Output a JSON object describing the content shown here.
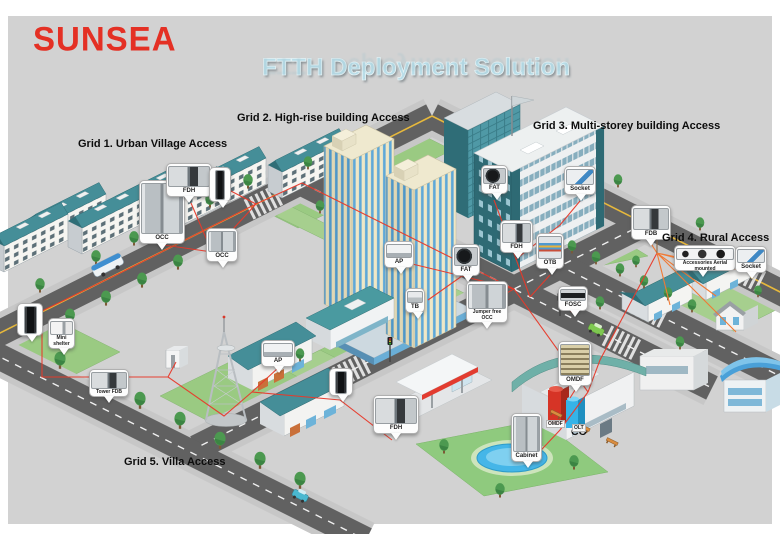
{
  "brand": {
    "logo_text": "SUNSEA",
    "logo_color": "#e43024"
  },
  "title": "FTTH Deployment Solution",
  "grid_labels": {
    "grid1": "Grid 1. Urban Village Access",
    "grid2": "Grid 2. High-rise building Access",
    "grid3": "Grid 3. Multi-storey building Access",
    "grid4": "Grid 4. Rural Access",
    "grid5": "Grid 5. Villa Access"
  },
  "central_office": {
    "label": "CO",
    "omdf_label": "OMDF",
    "olt_label": "OLT"
  },
  "callouts": [
    {
      "label": "OCC",
      "device": "indoor-optical-cabinet"
    },
    {
      "label": "FDH",
      "device": "fiber-distribution-hub"
    },
    {
      "label": "OCC",
      "device": "wall-mounted-cabinet"
    },
    {
      "label": "AP",
      "device": "access-point-panel"
    },
    {
      "label": "TB",
      "device": "terminal-box"
    },
    {
      "label": "FAT",
      "device": "fiber-access-terminal"
    },
    {
      "label": "Jumper free OCC",
      "device": "street-cabinet"
    },
    {
      "label": "FAT",
      "device": "fiber-access-terminal"
    },
    {
      "label": "Socket",
      "device": "fiber-socket"
    },
    {
      "label": "FDH",
      "device": "fiber-distribution-hub"
    },
    {
      "label": "OTB",
      "device": "optical-terminal-box"
    },
    {
      "label": "FOSC",
      "device": "fiber-splice-closure"
    },
    {
      "label": "FDB",
      "device": "fiber-distribution-box"
    },
    {
      "label": "Accessories Aerial mounted",
      "device": "aerial-accessories"
    },
    {
      "label": "Socket",
      "device": "fiber-socket"
    },
    {
      "label": "OMDF",
      "device": "distribution-frame-rack"
    },
    {
      "label": "Mini shelter",
      "device": "mini-shelter"
    },
    {
      "label": "Tower FDB",
      "device": "fiber-distribution-box"
    },
    {
      "label": "AP",
      "device": "access-point-panel"
    },
    {
      "label": "FDH",
      "device": "fiber-distribution-hub"
    },
    {
      "label": "Cabinet",
      "device": "outdoor-cabinet"
    }
  ],
  "unlabeled_closures": [
    {
      "device": "aerial-splice-closure"
    },
    {
      "device": "aerial-splice-closure"
    },
    {
      "device": "aerial-splice-closure"
    }
  ],
  "colors": {
    "background_panel": "#d2d2d2",
    "fiber_route_red": "#e8392a",
    "rural_fan_orange": "#f07a35",
    "title_blue": "#b9dde8",
    "roof_teal": "#458e98"
  }
}
